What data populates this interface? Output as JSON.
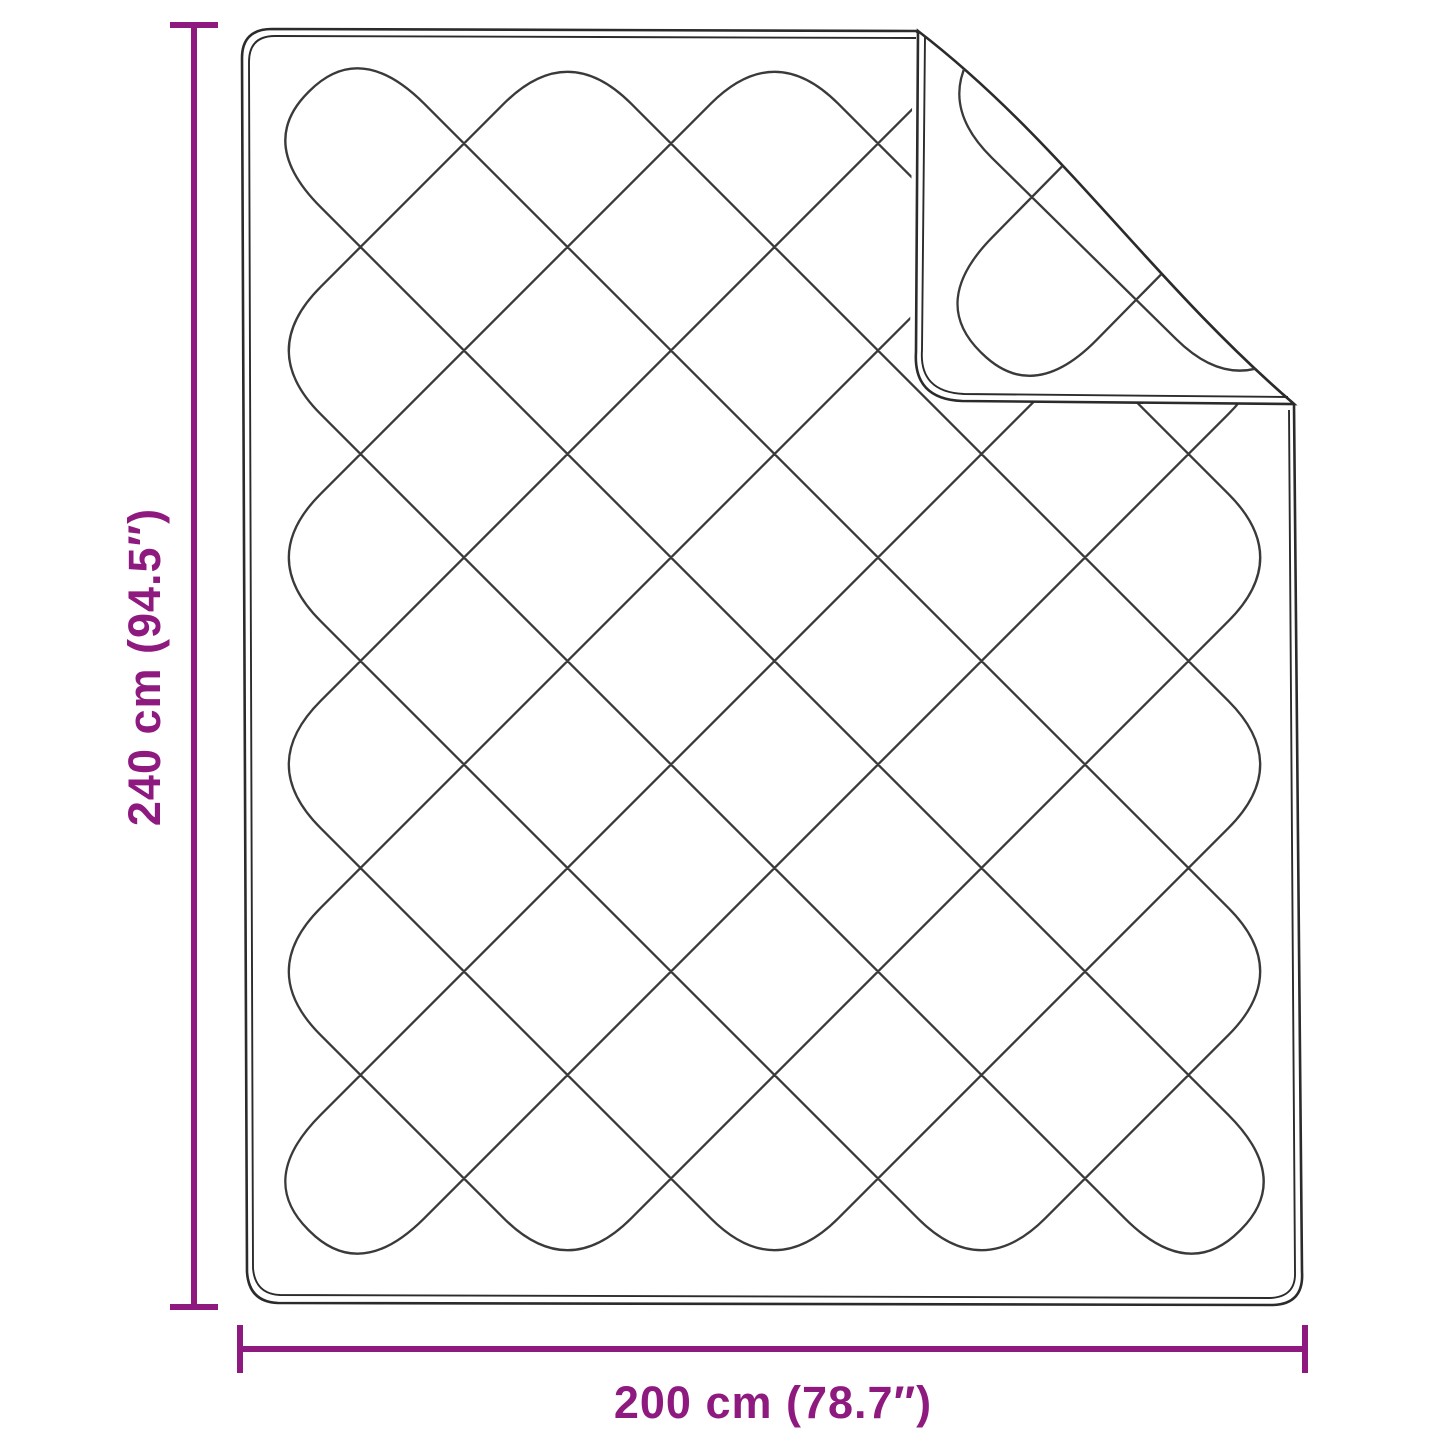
{
  "diagram": {
    "title": "blanket dimension diagram",
    "height_dimension_label": "240 cm (94.5″)",
    "width_dimension_label": "200 cm (78.7″)"
  },
  "colors": {
    "accent": "#8E1A7F",
    "stitch": "#3A3A3A",
    "outline": "#2B2B2B",
    "background": "#FFFFFF"
  }
}
